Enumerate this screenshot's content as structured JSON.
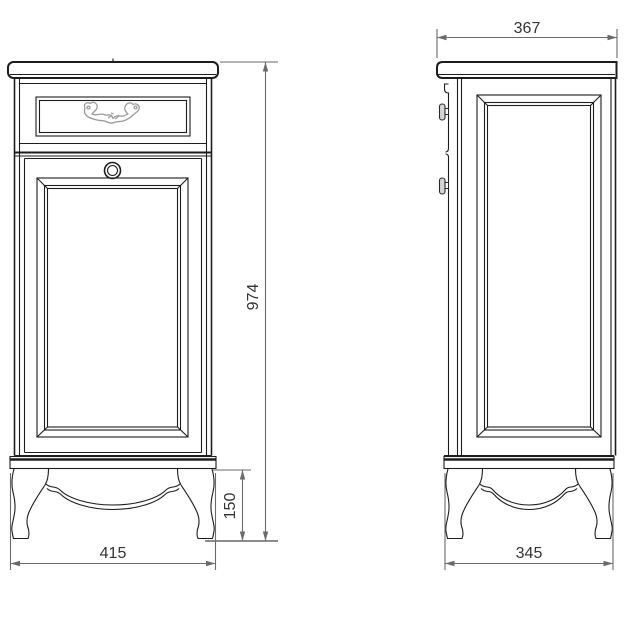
{
  "drawing": {
    "title": "cabinet-dimension-drawing",
    "views": {
      "front": {
        "name": "front-view"
      },
      "side": {
        "name": "side-view"
      }
    },
    "dimensions": {
      "overall_height": "974",
      "base_width": "415",
      "leg_height": "150",
      "top_depth": "367",
      "base_depth": "345"
    },
    "colors": {
      "background": "#ffffff",
      "object_line": "#1d1d1d",
      "dimension_line": "#6a6a6a",
      "floor_extension_line": "#8c8c8c",
      "dimension_text": "#333333",
      "ornament_line": "#9c9c9c"
    }
  }
}
